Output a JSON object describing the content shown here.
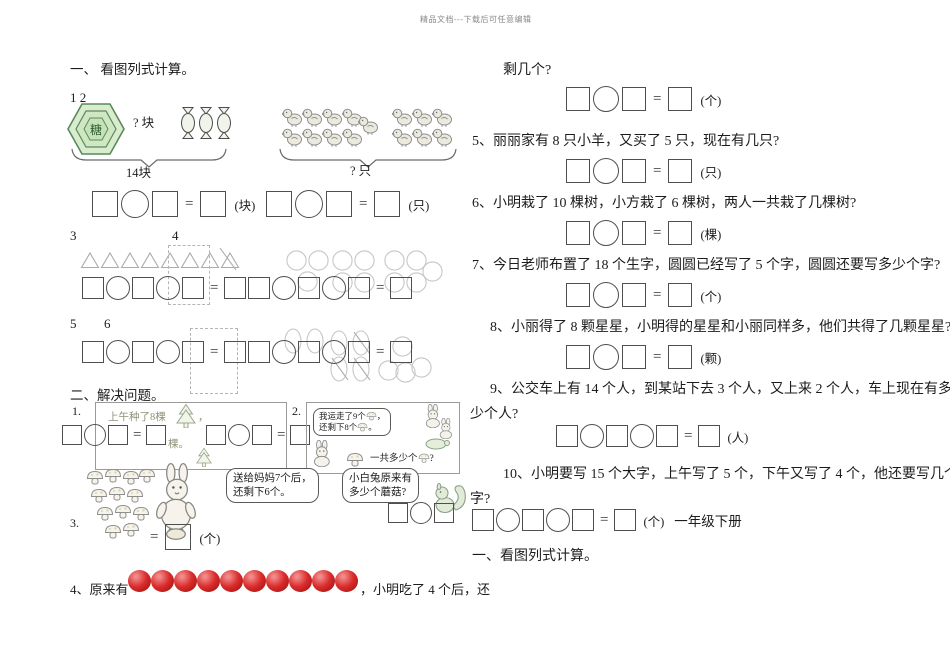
{
  "symbols": {
    "equals": "="
  },
  "header": {
    "watermark": "精品文档---下载后可任意编辑"
  },
  "colors": {
    "hexagon_fill": "#d9eccd",
    "hexagon_stroke": "#5a8a5d",
    "apple_red": "#c9231f"
  },
  "figures": {
    "candies_count": 3,
    "chicks_left_group": 9,
    "chicks_right_group": 6,
    "triangles_count": 8,
    "circle_cluster_counts": [
      3,
      4,
      5
    ],
    "apples_count": 10
  },
  "left": {
    "section1_title": "一、 看图列式计算。",
    "label_12": "1 2",
    "label_3": "3",
    "label_4": "4",
    "label_5": "5",
    "label_6": "6",
    "candy": {
      "hex_label": "糖",
      "question": "? 块",
      "brace_total": "14块"
    },
    "chicks": {
      "brace_question": "? 只"
    },
    "eq_row1": {
      "unit1": "(块)",
      "unit2": "(只)"
    },
    "section2_title": "二、解决问题。",
    "prob1": {
      "num": "1.",
      "caption": "上午种了8棵",
      "punct": "，",
      "fragment": "棵。"
    },
    "prob2": {
      "num": "2.",
      "bubble_line1": "我运走了9个",
      "punct1": "，",
      "bubble_line2": "还剩下8个",
      "punct2": "。",
      "question": "一共多少个",
      "qmark": "?"
    },
    "prob3": {
      "num": "3.",
      "bubble1_line1": "送给妈妈7个后，",
      "bubble1_line2": "还剩下6个。",
      "bubble2_line1": "小白兔原来有",
      "bubble2_line2": "多少个蘑菇?",
      "unit": "(个)"
    },
    "prob4": {
      "num": "4、",
      "text_before": "原来有",
      "text_after": "，小明吃了 4 个后，还"
    }
  },
  "right": {
    "prob4_cont": "剩几个?",
    "eq4_unit": "(个)",
    "items": [
      {
        "num": "5、",
        "text": "丽丽家有 8 只小羊，又买了 5 只，现在有几只?",
        "unit": "(只)"
      },
      {
        "num": "6、",
        "text": "小明栽了 10 棵树，小方栽了 6 棵树，两人一共栽了几棵树?",
        "unit": "(棵)"
      },
      {
        "num": "7、",
        "text": "今日老师布置了 18 个生字，圆圆已经写了 5 个字，圆圆还要写多少个字?",
        "unit": "(个)"
      },
      {
        "num": "8、",
        "text": "小丽得了 8 颗星星，小明得的星星和小丽同样多，他们共得了几颗星星?",
        "unit": "(颗)"
      },
      {
        "num": "9、",
        "text": "公交车上有 14 个人，到某站下去 3 个人，又上来 2 个人，车上现在有多",
        "text2": "少个人?",
        "unit": "(人)"
      },
      {
        "num": "10、",
        "text": "小明要写 15 个大字，上午写了 5 个，下午又写了 4 个，他还要写几个大",
        "text2": "字?",
        "unit": "(个)",
        "suffix": "一年级下册"
      }
    ],
    "section_next_title": "一、看图列式计算。"
  }
}
